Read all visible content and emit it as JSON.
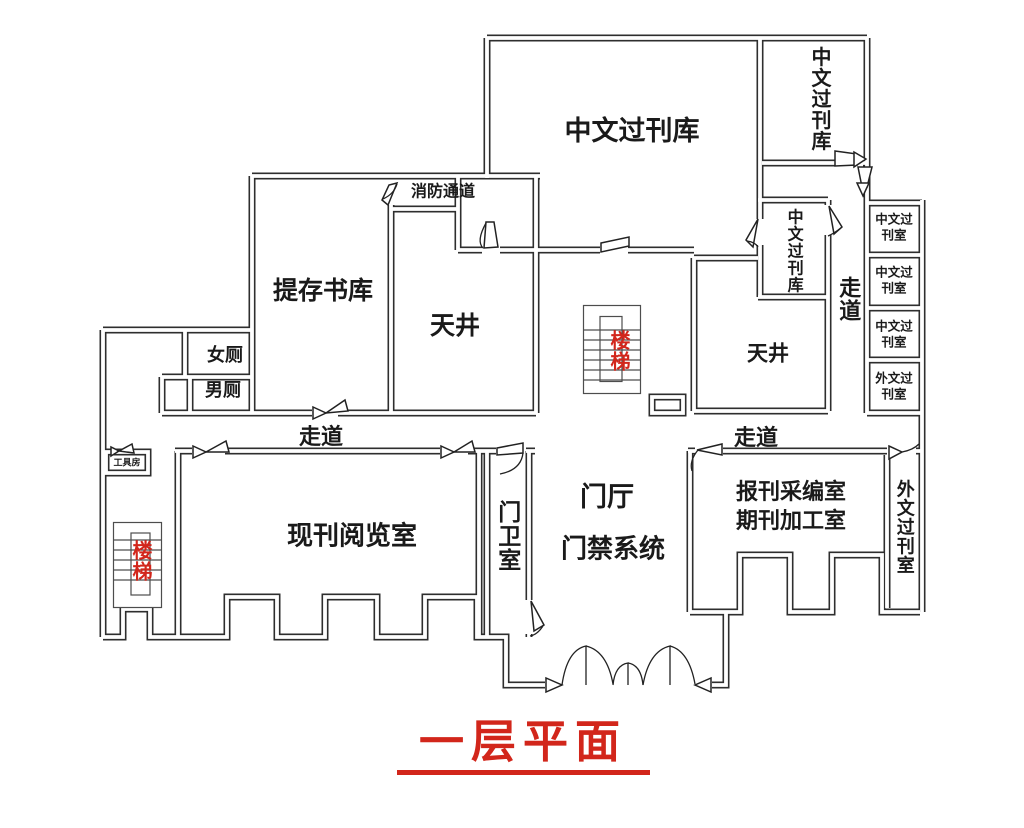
{
  "title": {
    "text": "一层平面"
  },
  "rooms": {
    "chinese_archive_main": "中文过刊库",
    "chinese_archive_top_right": "中文过刊库",
    "chinese_archive_small": "中文过刊库",
    "fire_passage": "消防通道",
    "deposit_stack": "提存书库",
    "lightwell_left": "天井",
    "lightwell_right": "天井",
    "corridor_vertical": "走道",
    "corridor_left": "走道",
    "corridor_right": "走道",
    "small_rooms": [
      "中文过刊室",
      "中文过刊室",
      "中文过刊室",
      "外文过刊室"
    ],
    "womens_toilet": "女厕",
    "mens_toilet": "男厕",
    "tool_room": "工具房",
    "reading_room": "现刊阅览室",
    "guard_room": "门卫室",
    "entrance_hall": "门厅",
    "access_control": "门禁系统",
    "editing_room_line1": "报刊采编室",
    "editing_room_line2": "期刊加工室",
    "foreign_archive_room": "外文过刊室",
    "stairs_middle": "楼梯",
    "stairs_left": "楼梯"
  },
  "colors": {
    "wall": "#2e2e2e",
    "accent_red": "#d2261b"
  }
}
